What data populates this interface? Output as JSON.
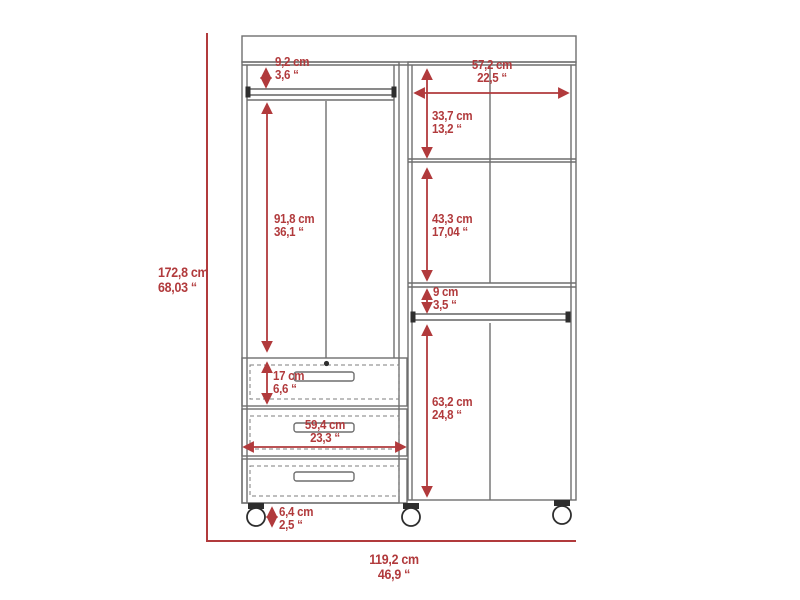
{
  "diagram": {
    "type": "furniture-dimension-drawing",
    "subject": "three-door mobile closet with drawers and casters",
    "units": [
      "cm",
      "inches"
    ]
  },
  "colors": {
    "dimension_red": "#b13a3c",
    "outline_gray": "#6f6f6f",
    "dark_detail": "#2e2e2e",
    "background": "#ffffff"
  },
  "dimensions": {
    "total_height": {
      "cm": "172,8 cm",
      "in": "68,03 “"
    },
    "total_width": {
      "cm": "119,2 cm",
      "in": "46,9 “"
    },
    "top_rod_offset": {
      "cm": "9,2 cm",
      "in": "3,6 “"
    },
    "right_section_width": {
      "cm": "57,2 cm",
      "in": "22,5 “"
    },
    "right_top_shelf_height": {
      "cm": "33,7 cm",
      "in": "13,2 “"
    },
    "left_hanging_height": {
      "cm": "91,8 cm",
      "in": "36,1 “"
    },
    "right_middle_shelf_height": {
      "cm": "43,3 cm",
      "in": "17,04 “"
    },
    "right_rod_gap": {
      "cm": "9 cm",
      "in": "3,5 “"
    },
    "right_door_height": {
      "cm": "63,2 cm",
      "in": "24,8 “"
    },
    "drawer_height": {
      "cm": "17 cm",
      "in": "6,6 “"
    },
    "drawer_width": {
      "cm": "59,4 cm",
      "in": "23,3 “"
    },
    "caster_height": {
      "cm": "6,4 cm",
      "in": "2,5 “"
    }
  }
}
